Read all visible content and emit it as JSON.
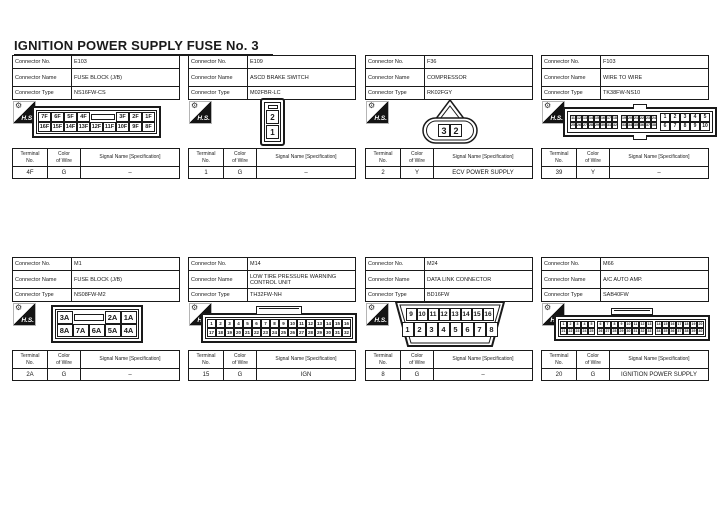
{
  "title": "IGNITION POWER SUPPLY FUSE No. 3",
  "labels": {
    "connector_no": "Connector No.",
    "connector_name": "Connector Name",
    "connector_type": "Connector Type",
    "terminal_l1": "Terminal",
    "terminal_l2": "No.",
    "color_l1": "Color",
    "color_l2": "of Wire",
    "signal": "Signal Name [Specification]",
    "hs": "H.S."
  },
  "connectors": [
    {
      "no": "E103",
      "name": "FUSE BLOCK (J/B)",
      "type": "NS16FW-CS",
      "terminal": {
        "no": "4F",
        "color": "G",
        "signal": "–"
      },
      "pins": {
        "top_left": [
          "7F",
          "6F",
          "5F",
          "4F"
        ],
        "top_right": [
          "3F",
          "2F",
          "1F"
        ],
        "bottom": [
          "16F",
          "15F",
          "14F",
          "13F",
          "12F",
          "11F",
          "10F",
          "9F",
          "8F"
        ]
      }
    },
    {
      "no": "E109",
      "name": "ASCD BRAKE SWITCH",
      "type": "M02FBR-LC",
      "terminal": {
        "no": "1",
        "color": "G",
        "signal": "–"
      },
      "pins": {
        "cells": [
          "2",
          "1"
        ]
      }
    },
    {
      "no": "F36",
      "name": "COMPRESSOR",
      "type": "RK02FGY",
      "terminal": {
        "no": "2",
        "color": "Y",
        "signal": "ECV POWER SUPPLY"
      },
      "pins": {
        "left": "3",
        "right": "2"
      }
    },
    {
      "no": "F103",
      "name": "WIRE TO WIRE",
      "type": "TK38FW-NS10",
      "terminal": {
        "no": "39",
        "color": "Y",
        "signal": "–"
      },
      "pins": {
        "small1_top": [
          "11",
          "12",
          "13",
          "14",
          "15",
          "16",
          "17",
          "18"
        ],
        "small1_bottom": [
          "25",
          "26",
          "27",
          "28",
          "29",
          "30",
          "31",
          "32"
        ],
        "small2_top": [
          "19",
          "20",
          "21",
          "22",
          "23",
          "24"
        ],
        "small2_bottom": [
          "33",
          "34",
          "35",
          "36",
          "37",
          "38"
        ],
        "large_top": [
          "1",
          "2",
          "3",
          "4",
          "5"
        ],
        "large_bottom": [
          "6",
          "7",
          "8",
          "9",
          "10"
        ]
      }
    },
    {
      "no": "M1",
      "name": "FUSE BLOCK (J/B)",
      "type": "NS08FW-M2",
      "terminal": {
        "no": "2A",
        "color": "G",
        "signal": "–"
      },
      "pins": {
        "top_left": [
          "3A"
        ],
        "top_right": [
          "2A",
          "1A"
        ],
        "bottom": [
          "8A",
          "7A",
          "6A",
          "5A",
          "4A"
        ]
      }
    },
    {
      "no": "M14",
      "name": "LOW TIRE PRESSURE WARNING CONTROL UNIT",
      "type": "TH32FW-NH",
      "terminal": {
        "no": "15",
        "color": "G",
        "signal": "IGN"
      },
      "pins": {
        "top": [
          "1",
          "2",
          "3",
          "4",
          "5",
          "6",
          "7",
          "8",
          "9",
          "10",
          "11",
          "12",
          "13",
          "14",
          "15",
          "16"
        ],
        "bottom": [
          "17",
          "18",
          "19",
          "20",
          "21",
          "22",
          "23",
          "24",
          "25",
          "26",
          "27",
          "28",
          "29",
          "30",
          "31",
          "32"
        ]
      }
    },
    {
      "no": "M24",
      "name": "DATA LINK CONNECTOR",
      "type": "BD16FW",
      "terminal": {
        "no": "8",
        "color": "G",
        "signal": "–"
      },
      "pins": {
        "top": [
          "9",
          "10",
          "11",
          "12",
          "13",
          "14",
          "15",
          "16"
        ],
        "bottom": [
          "1",
          "2",
          "3",
          "4",
          "5",
          "6",
          "7",
          "8"
        ]
      }
    },
    {
      "no": "M66",
      "name": "A/C AUTO AMP.",
      "type": "SAB40FW",
      "terminal": {
        "no": "20",
        "color": "G",
        "signal": "IGNITION POWER SUPPLY"
      },
      "pins": {
        "top": [
          "1",
          "2",
          "3",
          "4",
          "5",
          "6",
          "7",
          "8",
          "9",
          "10",
          "11",
          "12",
          "13",
          "14",
          "15",
          "16",
          "17",
          "18",
          "19",
          "20"
        ],
        "bottom": [
          "21",
          "22",
          "23",
          "24",
          "25",
          "26",
          "27",
          "28",
          "29",
          "30",
          "31",
          "32",
          "33",
          "34",
          "35",
          "36",
          "37",
          "38",
          "39",
          "40"
        ]
      }
    }
  ]
}
